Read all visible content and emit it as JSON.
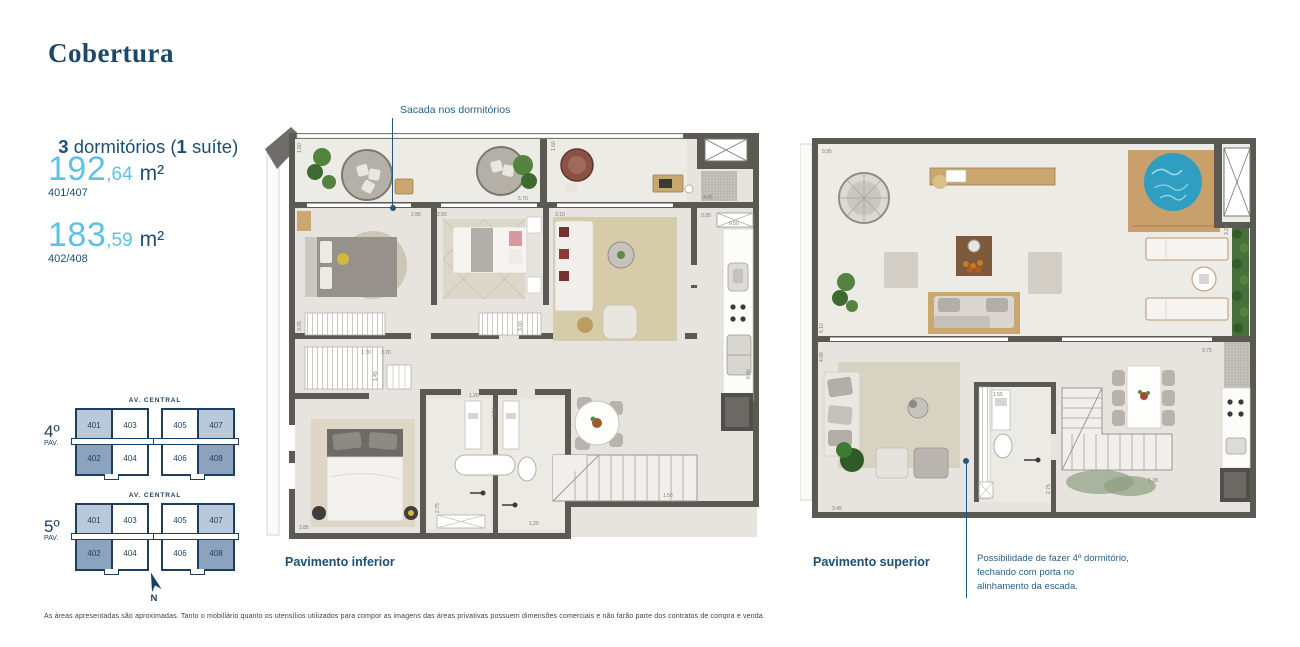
{
  "header": {
    "title": "Cobertura"
  },
  "summary": {
    "bedrooms_bold": "3",
    "bedrooms_text": " dormitórios (",
    "suite_bold": "1",
    "suite_text": " suíte)"
  },
  "areas": [
    {
      "value_int": "192",
      "value_dec": ",64",
      "unit": "m²",
      "units_label": "401/407"
    },
    {
      "value_int": "183",
      "value_dec": ",59",
      "unit": "m²",
      "units_label": "402/408"
    }
  ],
  "keyplans": [
    {
      "street": "AV. CENTRAL",
      "floor": "4º",
      "floor_suffix": "PAV.",
      "left_block": {
        "top": [
          "401",
          "403"
        ],
        "bottom": [
          "402",
          "404"
        ]
      },
      "right_block": {
        "top": [
          "405",
          "407"
        ],
        "bottom": [
          "406",
          "408"
        ]
      }
    },
    {
      "street": "AV. CENTRAL",
      "floor": "5º",
      "floor_suffix": "PAV.",
      "left_block": {
        "top": [
          "401",
          "403"
        ],
        "bottom": [
          "402",
          "404"
        ]
      },
      "right_block": {
        "top": [
          "405",
          "407"
        ],
        "bottom": [
          "406",
          "408"
        ]
      }
    }
  ],
  "compass": {
    "label": "N"
  },
  "plans": {
    "inferior": {
      "label": "Pavimento inferior",
      "annotation": "Sacada nos dormitórios",
      "dims": {
        "d1": "1.60",
        "d2": "5.70",
        "d3": "2.85",
        "d4": "2.55",
        "d5": "3.10",
        "d6": "4.05",
        "d7": "0.95",
        "d8": "0.50",
        "d9": "1.70",
        "d10": "3.70",
        "d11": "1.45",
        "d12": "1.20",
        "d13": "3.10",
        "d14": "2.75",
        "d15": "2.85",
        "d16": "1.20",
        "d17": "1.56",
        "d18": "6.40",
        "d19": "3.05",
        "d20": "3.00",
        "d21": "1.60"
      }
    },
    "superior": {
      "label": "Pavimento superior",
      "annotation_lines": [
        "Possibilidade de fazer 4º dormitório,",
        "fechando com porta no",
        "alinhamento da escada."
      ],
      "dims": {
        "d1": "9.95",
        "d2": "5.10",
        "d3": "3.20",
        "d4": "4.08",
        "d5": "9.75",
        "d6": "1.55",
        "d7": "2.75",
        "d8": "3.45",
        "d9": "1.28"
      }
    }
  },
  "footer": {
    "disclaimer": "As áreas apresentadas são aproximadas. Tanto o mobiliário quanto os utensílios utilizados para compor as imagens das áreas privativas possuem dimensões comerciais e não farão parte dos contratos de compra e venda."
  },
  "colors": {
    "navy": "#1c4a6e",
    "light_blue": "#5ec1e6",
    "keyplan_highlight_light": "#b9c9da",
    "keyplan_highlight_dark": "#8ba3bf"
  }
}
